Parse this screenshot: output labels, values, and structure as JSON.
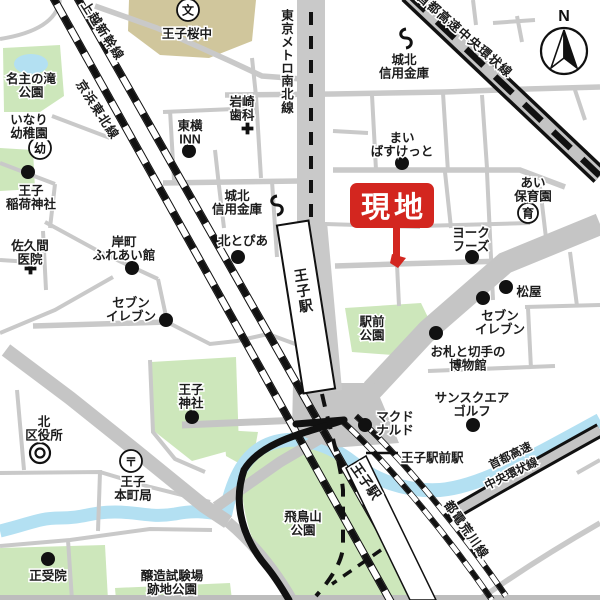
{
  "map": {
    "site_marker": {
      "label": "現地",
      "color": "#d3261f"
    },
    "labels": {
      "school": "王子桜中",
      "nanushi_park": "名主の滝\n公園",
      "inari_kindergarten": "いなり\n幼稚園",
      "oji_inari_shrine": "王子\n稲荷神社",
      "sakuma_clinic": "佐久間\n医院",
      "kishimachi_hall": "岸町\nふれあい館",
      "seven_eleven_west": "セブン\nイレブン",
      "hokutopia": "北とぴあ",
      "johoku_bank_west": "城北\n信用金庫",
      "toyoko_inn": "東横\nINN",
      "iwasaki_dental": "岩崎\n歯科",
      "metro_namboku_line": "東京メトロ南北線",
      "shinkansen_line": "東北・上越新幹線",
      "keihin_tohoku_line": "京浜東北線",
      "johoku_bank_north": "城北\n信用金庫",
      "shuto_expressway_north": "首都高速中央環状線",
      "my_basket": "まい\nばすけっと",
      "ai_nursery": "あい\n保育園",
      "york_foods": "ヨーク\nフーズ",
      "matsuya": "松屋",
      "seven_eleven_east": "セブン\nイレブン",
      "stamp_museum": "お札と切手の\n博物館",
      "sunsquare_golf": "サンスクエア\nゴルフ",
      "mcdonalds": "マクド\nナルド",
      "ojiekimae_station": "王子駅前駅",
      "ekimae_park": "駅前\n公園",
      "oji_station": "王子駅",
      "oji_station_platform": "王子駅",
      "toden_arakawa_line": "都電荒川線",
      "shuto_expressway_south_1": "首都高速",
      "shuto_expressway_south_2": "中央環状線",
      "oji_shrine": "王子\n神社",
      "kita_ward_office": "北\n区役所",
      "oji_honcho_post": "王子\n本町局",
      "shojuin": "正受院",
      "jozo_park": "醸造試験場\n跡地公園",
      "asukayama_park": "飛鳥山\n公園",
      "compass_n": "N"
    },
    "symbols": {
      "school": "文",
      "kindergarten": "幼",
      "nursery": "育",
      "post_office": "〒"
    },
    "colors": {
      "road": "#c9c9c9",
      "park_green": "#cde7bb",
      "water_blue": "#b3e0f2",
      "school_tan": "#d0c69c",
      "rail_black": "#111111",
      "site_red": "#d3261f"
    }
  }
}
